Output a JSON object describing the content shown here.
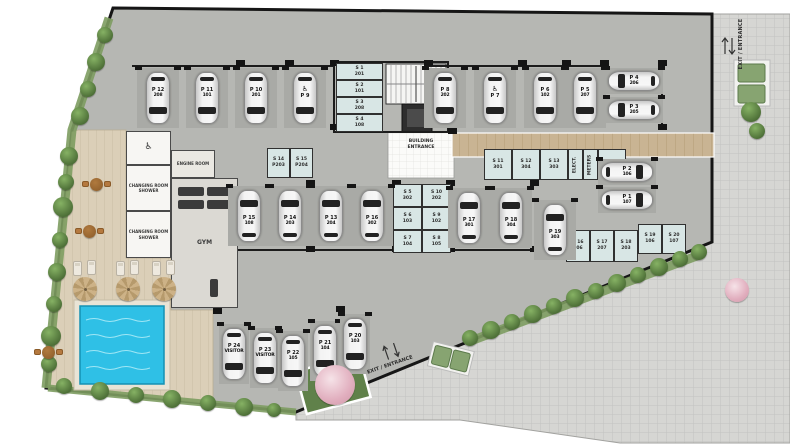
{
  "meta": {
    "type": "architectural site plan",
    "level": "parking / amenity level"
  },
  "labels": {
    "building_entrance": "BUILDING ENTRANCE",
    "engine_room": "ENGINE ROOM",
    "changing_room": "CHANGING ROOM\nSHOWER",
    "gym": "GYM",
    "exit_entrance": "EXIT / ENTRANCE",
    "wheelchair_icon": "♿"
  },
  "colors": {
    "garage_floor": "#b6b7b3",
    "stall": "#a9aaa6",
    "boundary": "#161616",
    "cobble_walkway": "#d6d6d3",
    "deck_wood": "#dbcfb8",
    "pool_water": "#2fc0e6",
    "storage_room": "#d8e6e5",
    "beige_path": "#c9b493",
    "bush_green": "#4e7038",
    "vent_green": "#87a471",
    "blossom_pink": "#e1aebe"
  },
  "parking": [
    {
      "id": "P 12",
      "unit": "208",
      "x": 137,
      "y": 68,
      "dir": "down"
    },
    {
      "id": "P 11",
      "unit": "101",
      "x": 186,
      "y": 68,
      "dir": "down"
    },
    {
      "id": "P 10",
      "unit": "201",
      "x": 235,
      "y": 68,
      "dir": "down"
    },
    {
      "id": "P 9",
      "unit": "",
      "handicap": true,
      "x": 284,
      "y": 68,
      "dir": "down"
    },
    {
      "id": "P 8",
      "unit": "202",
      "x": 424,
      "y": 68,
      "dir": "down"
    },
    {
      "id": "P 7",
      "unit": "",
      "handicap": true,
      "x": 474,
      "y": 68,
      "dir": "down"
    },
    {
      "id": "P 6",
      "unit": "102",
      "x": 524,
      "y": 68,
      "dir": "down"
    },
    {
      "id": "P 5",
      "unit": "207",
      "x": 564,
      "y": 68,
      "dir": "down"
    },
    {
      "id": "P 4",
      "unit": "206",
      "x": 605,
      "y": 68,
      "dir": "left"
    },
    {
      "id": "P 3",
      "unit": "205",
      "x": 605,
      "y": 97,
      "dir": "left"
    },
    {
      "id": "P 15",
      "unit": "108",
      "x": 228,
      "y": 186,
      "dir": "up"
    },
    {
      "id": "P 14",
      "unit": "203",
      "x": 269,
      "y": 186,
      "dir": "up"
    },
    {
      "id": "P 13",
      "unit": "204",
      "x": 310,
      "y": 186,
      "dir": "up"
    },
    {
      "id": "P 16",
      "unit": "302",
      "x": 351,
      "y": 186,
      "dir": "up"
    },
    {
      "id": "P 17",
      "unit": "301",
      "x": 448,
      "y": 188,
      "dir": "up"
    },
    {
      "id": "P 18",
      "unit": "304",
      "x": 490,
      "y": 188,
      "dir": "up"
    },
    {
      "id": "P 19",
      "unit": "303",
      "x": 534,
      "y": 200,
      "dir": "up"
    },
    {
      "id": "P 2",
      "unit": "106",
      "x": 598,
      "y": 159,
      "dir": "right"
    },
    {
      "id": "P 1",
      "unit": "107",
      "x": 598,
      "y": 187,
      "dir": "right"
    },
    {
      "id": "P 24",
      "unit": "VISITOR",
      "x": 219,
      "y": 324,
      "dir": "down",
      "w": 30
    },
    {
      "id": "P 23",
      "unit": "VISITOR",
      "x": 250,
      "y": 328,
      "dir": "down",
      "w": 30
    },
    {
      "id": "P 22",
      "unit": "105",
      "x": 278,
      "y": 331,
      "dir": "down",
      "w": 30
    },
    {
      "id": "P 21",
      "unit": "104",
      "x": 310,
      "y": 321,
      "dir": "down",
      "w": 30
    },
    {
      "id": "P 20",
      "unit": "103",
      "x": 340,
      "y": 314,
      "dir": "down",
      "w": 30
    }
  ],
  "storage": [
    {
      "id": "S 1",
      "unit": "201",
      "x": 336,
      "y": 63,
      "w": 47,
      "h": 17
    },
    {
      "id": "S 2",
      "unit": "101",
      "x": 336,
      "y": 80,
      "w": 47,
      "h": 17
    },
    {
      "id": "S 3",
      "unit": "208",
      "x": 336,
      "y": 97,
      "w": 47,
      "h": 17
    },
    {
      "id": "S 4",
      "unit": "108",
      "x": 336,
      "y": 114,
      "w": 47,
      "h": 18
    },
    {
      "id": "S 14",
      "unit": "P203",
      "x": 267,
      "y": 148,
      "w": 23,
      "h": 30
    },
    {
      "id": "S 15",
      "unit": "P204",
      "x": 290,
      "y": 148,
      "w": 23,
      "h": 30
    },
    {
      "id": "S 11",
      "unit": "301",
      "x": 484,
      "y": 149,
      "w": 28,
      "h": 31
    },
    {
      "id": "S 12",
      "unit": "304",
      "x": 512,
      "y": 149,
      "w": 28,
      "h": 31
    },
    {
      "id": "S 13",
      "unit": "303",
      "x": 540,
      "y": 149,
      "w": 28,
      "h": 31
    },
    {
      "id": "ELECT.",
      "unit": "",
      "x": 568,
      "y": 149,
      "w": 15,
      "h": 31,
      "rot": true
    },
    {
      "id": "METERS",
      "unit": "",
      "x": 583,
      "y": 149,
      "w": 15,
      "h": 31,
      "rot": true
    },
    {
      "id": "EAC",
      "unit": "",
      "x": 598,
      "y": 149,
      "w": 28,
      "h": 31
    },
    {
      "id": "S 5",
      "unit": "302",
      "x": 393,
      "y": 184,
      "w": 29,
      "h": 23
    },
    {
      "id": "S 10",
      "unit": "202",
      "x": 422,
      "y": 184,
      "w": 29,
      "h": 23
    },
    {
      "id": "S 6",
      "unit": "103",
      "x": 393,
      "y": 207,
      "w": 29,
      "h": 23
    },
    {
      "id": "S 9",
      "unit": "102",
      "x": 422,
      "y": 207,
      "w": 29,
      "h": 23
    },
    {
      "id": "S 7",
      "unit": "104",
      "x": 393,
      "y": 230,
      "w": 29,
      "h": 23
    },
    {
      "id": "S 8",
      "unit": "105",
      "x": 422,
      "y": 230,
      "w": 29,
      "h": 23
    },
    {
      "id": "S 16",
      "unit": "206",
      "x": 566,
      "y": 230,
      "w": 24,
      "h": 32
    },
    {
      "id": "S 17",
      "unit": "207",
      "x": 590,
      "y": 230,
      "w": 24,
      "h": 32
    },
    {
      "id": "S 18",
      "unit": "203",
      "x": 614,
      "y": 230,
      "w": 24,
      "h": 32
    },
    {
      "id": "S 19",
      "unit": "106",
      "x": 638,
      "y": 224,
      "w": 24,
      "h": 30
    },
    {
      "id": "S 20",
      "unit": "107",
      "x": 662,
      "y": 224,
      "w": 24,
      "h": 30
    }
  ],
  "facilities": [
    {
      "name": "wc",
      "label": "",
      "x": 126,
      "y": 131,
      "w": 45,
      "h": 34,
      "fill": "#f7f6f3",
      "fs": 4.5
    },
    {
      "name": "engine-room",
      "label": "ENGINE ROOM",
      "x": 171,
      "y": 150,
      "w": 44,
      "h": 28,
      "fill": "#eae8e2",
      "fs": 4
    },
    {
      "name": "changing-room-1",
      "label": "CHANGING ROOM\nSHOWER",
      "x": 126,
      "y": 165,
      "w": 45,
      "h": 46,
      "fill": "#f7f6f3",
      "fs": 4
    },
    {
      "name": "changing-room-2",
      "label": "CHANGING ROOM\nSHOWER",
      "x": 126,
      "y": 211,
      "w": 45,
      "h": 47,
      "fill": "#f7f6f3",
      "fs": 4
    },
    {
      "name": "gym",
      "label": "GYM",
      "x": 171,
      "y": 178,
      "w": 67,
      "h": 130,
      "fill": "#dbd9d3",
      "fs": 6
    }
  ],
  "landscape": {
    "bushes": [
      [
        105,
        35,
        8
      ],
      [
        96,
        62,
        9
      ],
      [
        88,
        89,
        8
      ],
      [
        80,
        116,
        9
      ],
      [
        69,
        156,
        9
      ],
      [
        66,
        182,
        8
      ],
      [
        63,
        207,
        10
      ],
      [
        60,
        240,
        8
      ],
      [
        57,
        272,
        9
      ],
      [
        54,
        304,
        8
      ],
      [
        51,
        336,
        10
      ],
      [
        49,
        364,
        8
      ],
      [
        64,
        386,
        8
      ],
      [
        100,
        391,
        9
      ],
      [
        136,
        395,
        8
      ],
      [
        172,
        399,
        9
      ],
      [
        208,
        403,
        8
      ],
      [
        244,
        407,
        9
      ],
      [
        274,
        410,
        7
      ],
      [
        470,
        338,
        8
      ],
      [
        491,
        330,
        9
      ],
      [
        512,
        322,
        8
      ],
      [
        533,
        314,
        9
      ],
      [
        554,
        306,
        8
      ],
      [
        575,
        298,
        9
      ],
      [
        596,
        291,
        8
      ],
      [
        617,
        283,
        9
      ],
      [
        638,
        275,
        8
      ],
      [
        659,
        267,
        9
      ],
      [
        680,
        259,
        8
      ],
      [
        699,
        252,
        8
      ],
      [
        751,
        112,
        10
      ],
      [
        757,
        131,
        8
      ]
    ],
    "pink_trees": [
      [
        335,
        385,
        20
      ],
      [
        737,
        290,
        12
      ]
    ],
    "umbrellas": [
      [
        85,
        289
      ],
      [
        128,
        289
      ],
      [
        164,
        289
      ]
    ],
    "tables": [
      [
        96,
        184
      ],
      [
        89,
        231
      ],
      [
        48,
        352
      ]
    ]
  }
}
